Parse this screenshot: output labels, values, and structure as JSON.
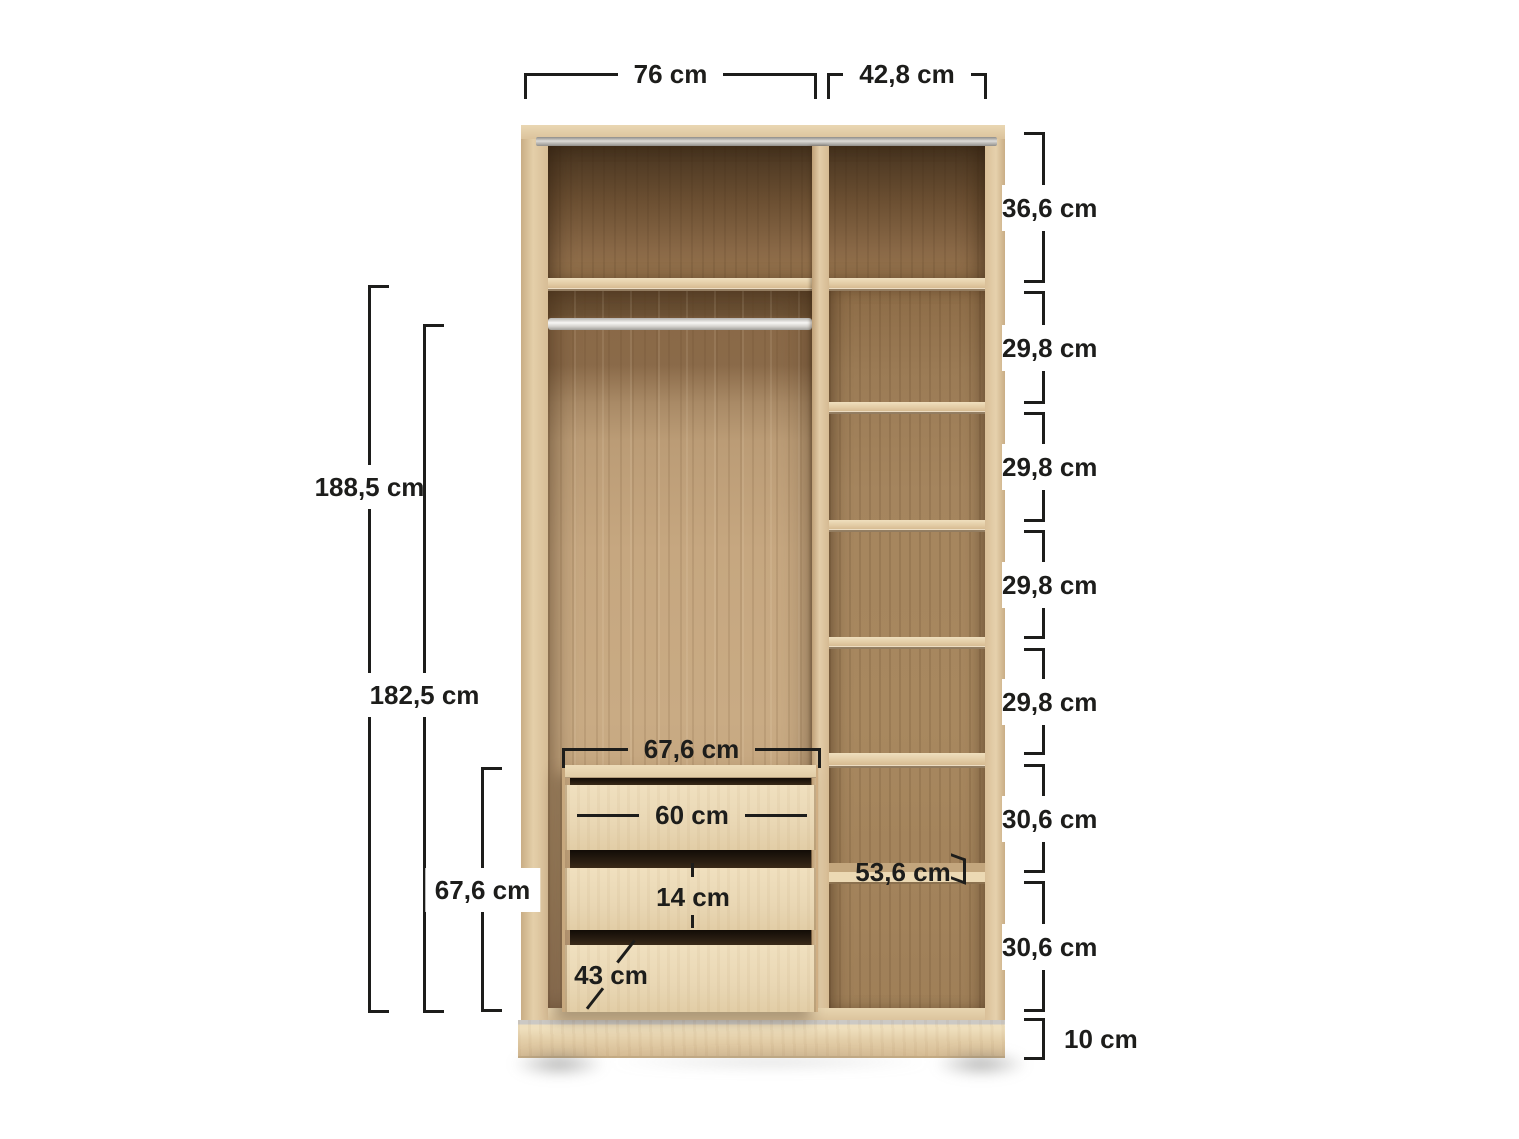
{
  "page": {
    "subject": "Open wardrobe interior dimension diagram",
    "background": "#ffffff"
  },
  "colors": {
    "dimension_text": "#1d1d1b",
    "wood_light": "#e4cfa9",
    "wood_medium": "#c2a37d",
    "wood_dark": "#6b5134",
    "rail_silver": "#d7d5d1",
    "background": "#ffffff"
  },
  "dimensions": {
    "unit": "cm",
    "top_widths": [
      {
        "name": "left-compartment-width",
        "value": "76 cm"
      },
      {
        "name": "right-compartment-width",
        "value": "42,8 cm"
      }
    ],
    "right_heights": [
      {
        "name": "top-compartment-height",
        "value": "36,6 cm"
      },
      {
        "name": "shelf-section-1-height",
        "value": "29,8 cm"
      },
      {
        "name": "shelf-section-2-height",
        "value": "29,8 cm"
      },
      {
        "name": "shelf-section-3-height",
        "value": "29,8 cm"
      },
      {
        "name": "shelf-section-4-height",
        "value": "29,8 cm"
      },
      {
        "name": "shelf-section-5-height",
        "value": "30,6 cm"
      },
      {
        "name": "shelf-section-6-height",
        "value": "30,6 cm"
      },
      {
        "name": "plinth-height",
        "value": "10 cm"
      }
    ],
    "left_heights": [
      {
        "name": "interior-height",
        "value": "188,5 cm"
      },
      {
        "name": "hanging-space-height",
        "value": "182,5 cm"
      },
      {
        "name": "drawer-unit-height",
        "value": "67,6 cm"
      }
    ],
    "inner": [
      {
        "name": "drawer-unit-width",
        "value": "67,6 cm"
      },
      {
        "name": "drawer-front-width",
        "value": "60 cm"
      },
      {
        "name": "drawer-inner-height",
        "value": "14 cm"
      },
      {
        "name": "drawer-depth",
        "value": "43 cm"
      },
      {
        "name": "shelf-depth",
        "value": "53,6 cm"
      }
    ]
  }
}
